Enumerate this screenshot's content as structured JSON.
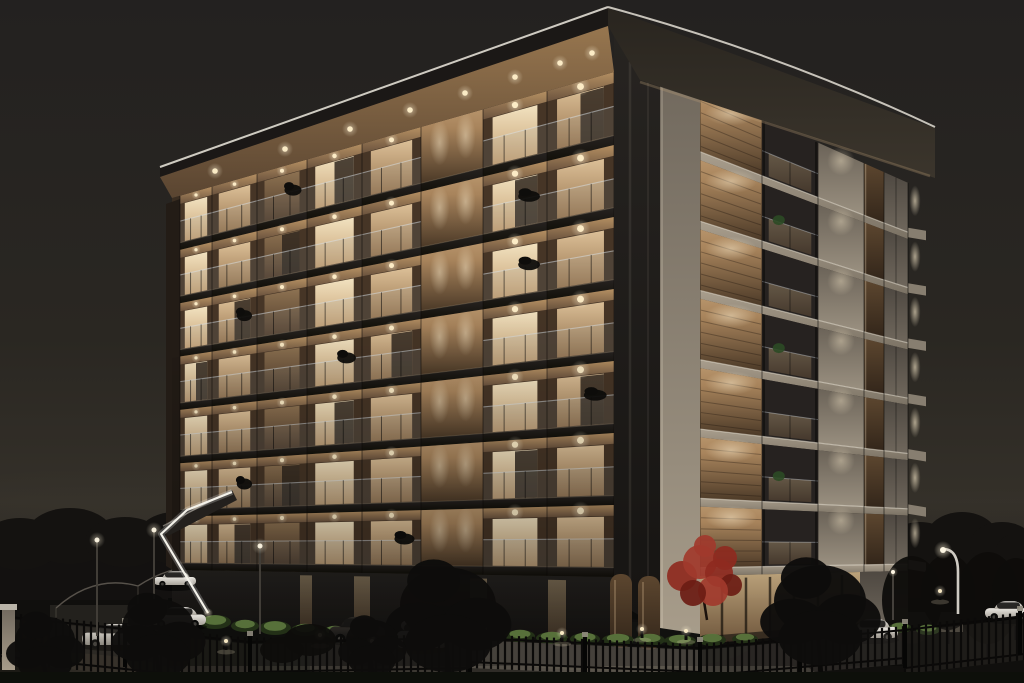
{
  "image": {
    "subject": "Night exterior rendering of a modern seven-storey apartment building with warmly illuminated balconies, glass railings, wood-slat cladding, a gated car park with white cars, landscaped shrubs, a red ornamental tree and street lamps",
    "time_of_day": "night"
  },
  "building": {
    "storeys": 7,
    "left_facade_bays": 8,
    "right_facade_bays": 5,
    "roof_overhang": true,
    "balcony_downlights": true
  },
  "site": {
    "visible_cars": 7,
    "street_lamps": 4,
    "bollard_lights": 7,
    "perimeter_fence": true,
    "entrance_led_strip": true,
    "red_trees": 1
  },
  "palette": {
    "sky_top": "#232120",
    "sky_horizon": "#343029",
    "roof_edge": "#d8d4ca",
    "roof_fascia": "#2e2a25",
    "soffit_wood": "#97764f",
    "window_glow": "#f2e2c0",
    "window_mid": "#dcc098",
    "wood_screen": "#a8845c",
    "wood_dark": "#4e3b2a",
    "concrete_light": "#a99e8d",
    "concrete_shade": "#6b6358",
    "glass_dark": "#272421",
    "railing_glass": "#96a3a8",
    "led_strip": "#f4f2ea",
    "downlight": "#ffefc9",
    "car_white": "#e9e6e0",
    "car_silver": "#cfccc5",
    "red_tree": "#8e2a20",
    "foliage_dark": "#0e0d0b",
    "foliage_lit": "#6a8647",
    "fence_iron": "#0b0a09",
    "lamp_light": "#fdf6e3",
    "ground_dark": "#100f0d",
    "driveway": "#2f2c27"
  }
}
